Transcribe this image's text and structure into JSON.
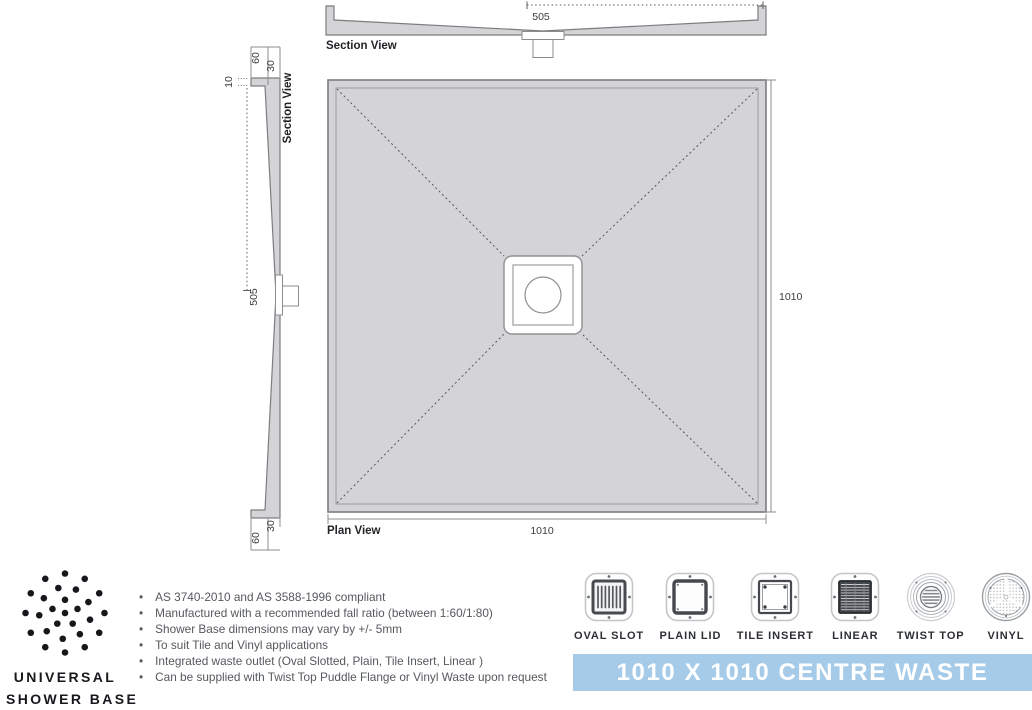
{
  "colors": {
    "banner_bg": "#a6cbe9",
    "banner_text": "#ffffff",
    "drawing_fill": "#d4d4d6",
    "drawing_stroke": "#7b7d80",
    "body_text": "#55585d",
    "brand_text": "#17181c"
  },
  "drawing": {
    "section_top": {
      "label": "Section View",
      "dim_half_width": "505"
    },
    "section_left": {
      "label": "Section View",
      "dim_half_height": "505",
      "dim_edge_top": "60",
      "dim_step_top": "30",
      "dim_lip": "10",
      "dim_step_bottom": "30",
      "dim_edge_bottom": "60"
    },
    "plan": {
      "label": "Plan View",
      "dim_width": "1010",
      "dim_height": "1010"
    }
  },
  "brand": {
    "name_line1": "UNIVERSAL",
    "name_line2": "SHOWER BASE"
  },
  "features": [
    "AS 3740-2010 and AS 3588-1996 compliant",
    "Manufactured with a recommended fall ratio (between 1:60/1:80)",
    "Shower Base dimensions may vary by +/- 5mm",
    "To suit Tile and Vinyl applications",
    "Integrated waste outlet (Oval Slotted, Plain, Tile Insert, Linear )",
    "Can be supplied with Twist Top Puddle Flange or Vinyl Waste upon request"
  ],
  "waste_options": [
    {
      "label": "OVAL SLOT"
    },
    {
      "label": "PLAIN LID"
    },
    {
      "label": "TILE INSERT"
    },
    {
      "label": "LINEAR"
    },
    {
      "label": "TWIST TOP"
    },
    {
      "label": "VINYL"
    }
  ],
  "banner": {
    "title": "1010 X 1010 CENTRE WASTE"
  }
}
